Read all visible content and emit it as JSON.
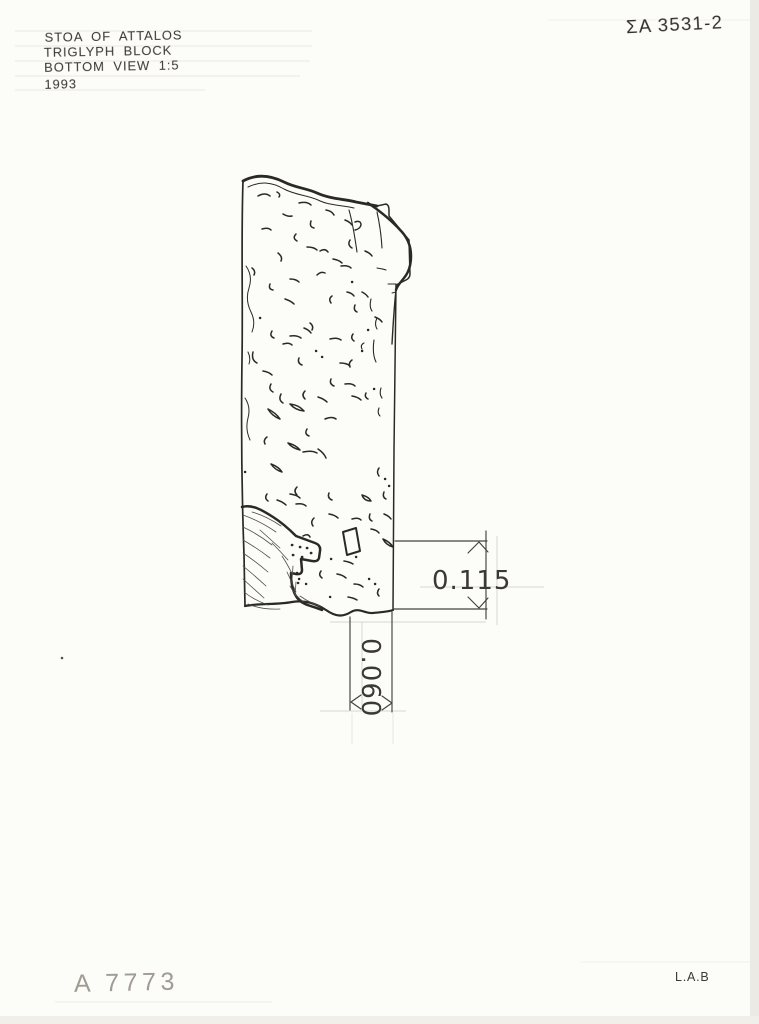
{
  "annotations": {
    "title_block": {
      "line1": "STOA OF ATTALOS",
      "line2": "TRIGLYPH BLOCK",
      "line3": "BOTTOM VIEW 1:5",
      "line4": "1993"
    },
    "catalog_number": "ΣA 3531-2",
    "inventory_number": "A 7773",
    "initials": "L.A.B"
  },
  "dimensions": {
    "width_label": "0.115",
    "depth_label": "0.060"
  },
  "colors": {
    "paper": "#fcfcf9",
    "ink": "#2b2924",
    "dimension_ink": "#45423d",
    "pencil": "#a09c94"
  }
}
